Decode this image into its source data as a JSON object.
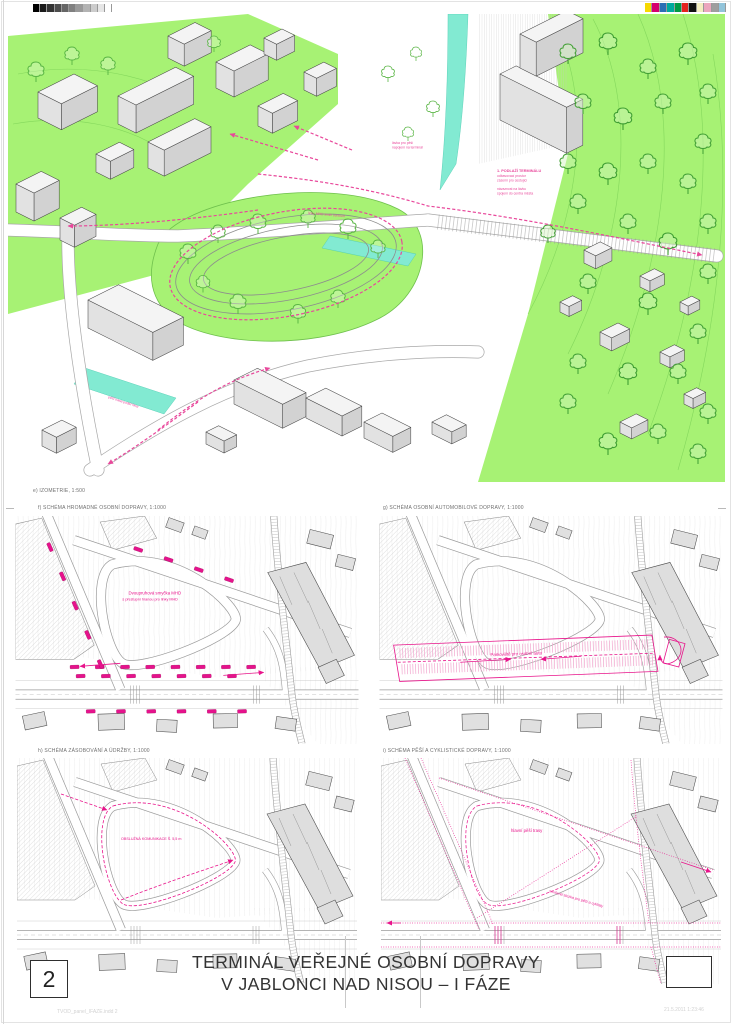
{
  "sheet": {
    "number": "2",
    "title_line1": "TERMINÁL VEŘEJNÉ OSOBNÍ DOPRAVY",
    "title_line2": "V JABLONCI NAD NISOU – I FÁZE",
    "footer_left": "TVOD_panel_IFAZE.indd 2",
    "footer_right": "21.5.2011 1:23:46"
  },
  "calibration": {
    "grayscale": [
      "#000000",
      "#1a1a1a",
      "#333333",
      "#4d4d4d",
      "#666666",
      "#808080",
      "#999999",
      "#b3b3b3",
      "#cccccc",
      "#e6e6e6",
      "#ffffff"
    ],
    "colors": [
      "#f6d800",
      "#d5006d",
      "#2b6fb5",
      "#00a99d",
      "#009a44",
      "#e5231f",
      "#111111",
      "#f4eec2",
      "#eba6bd",
      "#9e9e9e",
      "#92c4da"
    ]
  },
  "isometric": {
    "caption": "e) IZOMETRIE, 1:500",
    "labels": {
      "bridge_l1": "lávka pro pěší",
      "bridge_l2": "napojení na terminál",
      "roof_title": "1. PODLAŽÍ TERMINÁLU",
      "roof_l1": "odbavovací prostor",
      "roof_l2": "zázemí pro cestující",
      "roof_l3": "návaznost na lávku",
      "roof_l4": "spojení do centra města",
      "road": "linky MHD směr centrum",
      "south": "pěší trasa podél Nisy"
    }
  },
  "plans": [
    {
      "caption": "f) SCHÉMA HROMADNÉ OSOBNÍ DOPRAVY, 1:1000",
      "note1": "Dvoupruhová smyčka MHD",
      "note2": "s přestupní hranou pro linky MHD"
    },
    {
      "caption": "g) SCHÉMA OSOBNÍ AUTOMOBILOVÉ DOPRAVY, 1:1000",
      "note1": "Parkoviště pro osobní auta",
      "note2": ""
    },
    {
      "caption": "h) SCHÉMA ZÁSOBOVÁNÍ A ÚDRŽBY, 1:1000",
      "note1": "OBSLUŽNÁ KOMUNIKACE Š. 5,5 m",
      "note2": ""
    },
    {
      "caption": "i) SCHÉMA PĚŠÍ A CYKLISTICKÉ DOPRAVY, 1:1000",
      "note1": "hlavní pěší trasy",
      "note2": "smíšená stezka pro pěší a cyklisty"
    }
  ]
}
